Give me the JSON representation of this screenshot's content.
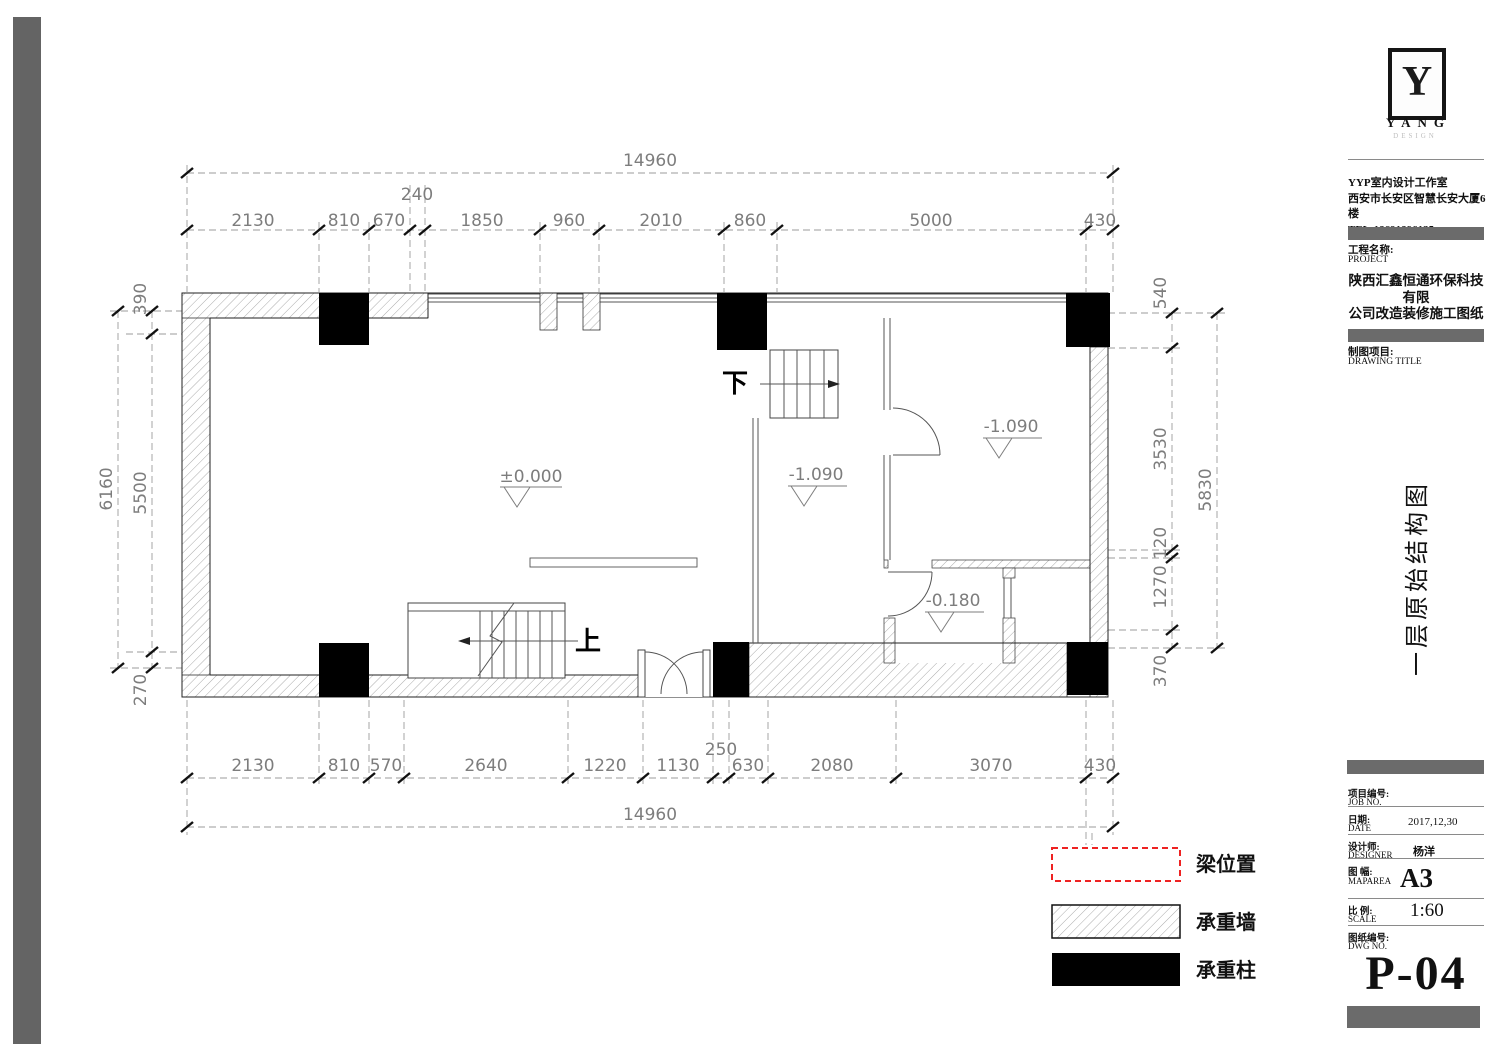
{
  "logo": {
    "letter": "Y",
    "name": "YANG",
    "subtitle": "DESIGN"
  },
  "studio": {
    "line1": "YYP室内设计工作室",
    "line2": "西安市长安区智慧长安大厦6楼",
    "line3": "TEL:18691896135"
  },
  "project": {
    "label_cn": "工程名称:",
    "label_en": "PROJECT",
    "name_line1": "陕西汇鑫恒通环保科技有限",
    "name_line2": "公司改造装修施工图纸"
  },
  "drawing": {
    "label_cn": "制图项目:",
    "label_en": "DRAWING TITLE",
    "title": "一层原始结构图"
  },
  "fields": {
    "job": {
      "cn": "项目编号:",
      "en": "JOB NO.",
      "value": ""
    },
    "date": {
      "cn": "日期:",
      "en": "DATE",
      "value": "2017,12,30"
    },
    "designer": {
      "cn": "设计师:",
      "en": "DESIGNER",
      "value": "杨洋"
    },
    "maparea": {
      "cn": "图 幅:",
      "en": "MAPAREA",
      "value": "A3"
    },
    "scale": {
      "cn": "比 例:",
      "en": "SCALE",
      "value": "1:60"
    },
    "dwg": {
      "cn": "图纸编号:",
      "en": "DWG NO.",
      "value": "P-04"
    }
  },
  "legend": {
    "items": [
      {
        "label": "梁位置",
        "symbol": "red-dashed-rectangle"
      },
      {
        "label": "承重墙",
        "symbol": "hatched-rectangle"
      },
      {
        "label": "承重柱",
        "symbol": "black-rectangle"
      }
    ]
  },
  "plan": {
    "levels": {
      "zero": "±0.000",
      "m1090": "-1.090",
      "m0180": "-0.180"
    },
    "stair_down": "下",
    "stair_up": "上",
    "dims": {
      "top_overall": "14960",
      "top": [
        "2130",
        "810",
        "670",
        "240",
        "1850",
        "960",
        "2010",
        "860",
        "5000",
        "430"
      ],
      "bottom": [
        "2130",
        "810",
        "570",
        "2640",
        "1220",
        "1130",
        "250",
        "630",
        "2080",
        "3070",
        "430"
      ],
      "bottom_overall": "14960",
      "left": [
        "390",
        "6160",
        "5500",
        "270"
      ],
      "right": [
        "540",
        "3530",
        "5830",
        "120",
        "1270",
        "370"
      ]
    }
  },
  "colors": {
    "beam_red": "#ee2222",
    "titlebar_gray": "#6b6b6b",
    "binding_bar_gray": "#646464",
    "column_black": "#000000"
  }
}
